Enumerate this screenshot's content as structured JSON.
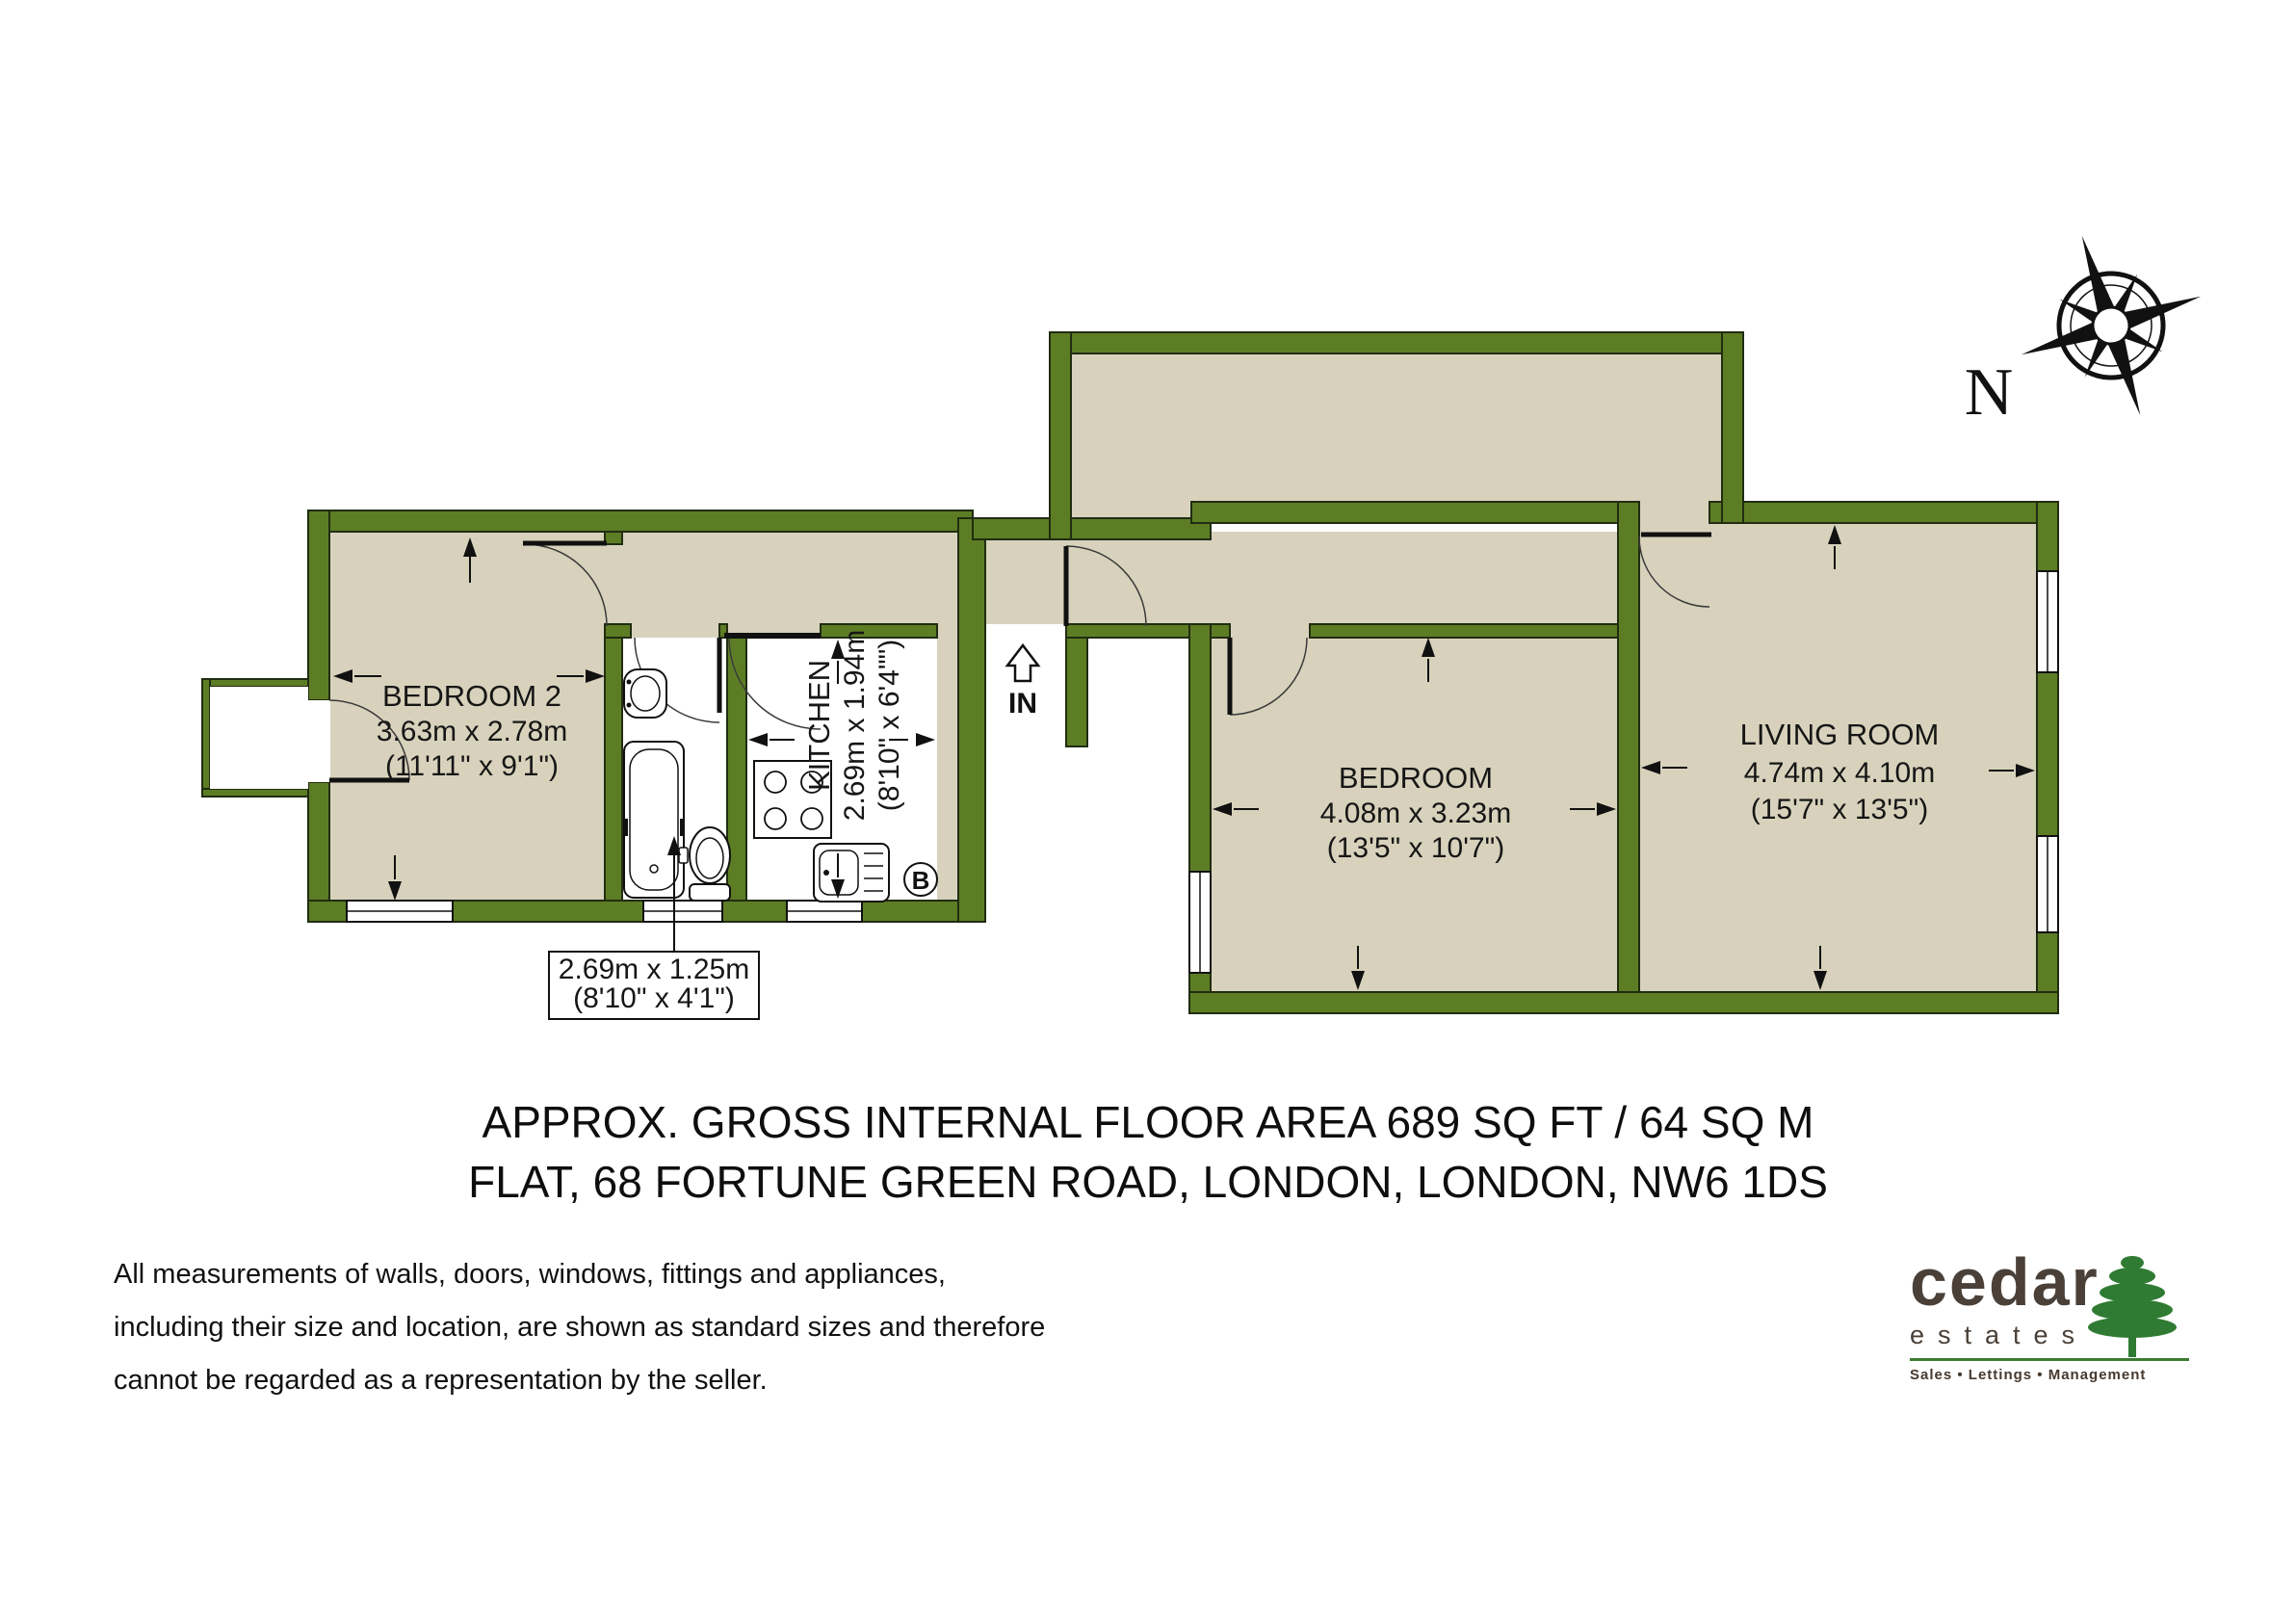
{
  "plan": {
    "colors": {
      "wall": "#5d7d25",
      "floor": "#d8d2bc",
      "bath_floor": "#ffffff",
      "logo_green": "#3e7a33",
      "logo_brown": "#4a4038"
    },
    "compass": {
      "label": "N"
    },
    "entrance": {
      "label": "IN"
    },
    "boiler": {
      "label": "B"
    },
    "rooms": {
      "bedroom2": {
        "name": "BEDROOM 2",
        "metric": "3.63m x 2.78m",
        "imperial": "(11'11\" x 9'1\")"
      },
      "kitchen": {
        "name": "KITCHEN",
        "metric": "2.69m x 1.94m",
        "imperial": "(8'10\" x 6'4\"\")"
      },
      "bedroom": {
        "name": "BEDROOM",
        "metric": "4.08m x 3.23m",
        "imperial": "(13'5\" x 10'7\")"
      },
      "living_room": {
        "name": "LIVING ROOM",
        "metric": "4.74m x 4.10m",
        "imperial": "(15'7\" x 13'5\")"
      },
      "bathroom_callout": {
        "metric": "2.69m x 1.25m",
        "imperial": "(8'10\" x 4'1\")"
      }
    }
  },
  "title": {
    "line1": "APPROX. GROSS INTERNAL FLOOR AREA 689 SQ FT / 64 SQ M",
    "line2": "FLAT, 68 FORTUNE GREEN ROAD, LONDON, LONDON, NW6 1DS"
  },
  "disclaimer": {
    "line1": "All measurements of walls, doors, windows, fittings and appliances,",
    "line2": "including their size and location, are shown as standard sizes and therefore",
    "line3": "cannot be regarded as a representation by the seller."
  },
  "logo": {
    "brand": "cedar",
    "brand2": "estates",
    "tagline": "Sales • Lettings • Management"
  }
}
